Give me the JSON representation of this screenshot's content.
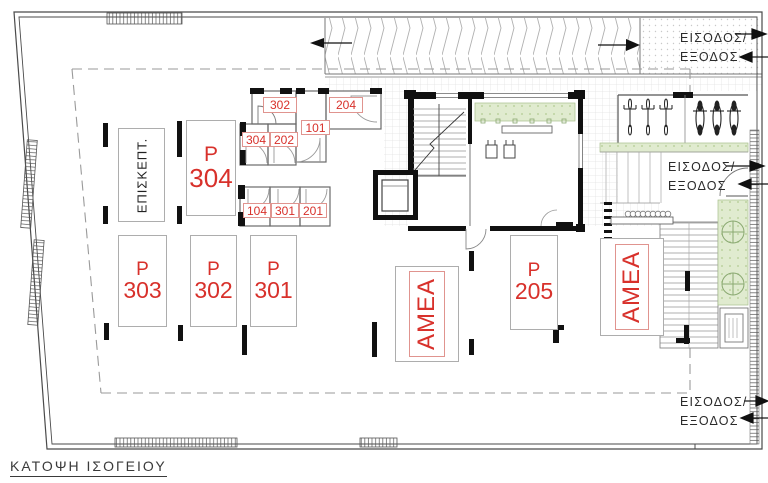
{
  "title": "ΚΑΤΟΨΗ ΙΣΟΓΕΙΟΥ",
  "colors": {
    "label_red": "#d8312b",
    "wall_black": "#111111",
    "line_gray": "#777777",
    "planting_green": "#e0ebcf"
  },
  "entrances": {
    "top_right": {
      "line1": "ΕΙΣΟΔΟΣ/",
      "line2": "ΕΞΟΔΟΣ"
    },
    "mid_right": {
      "line1": "ΕΙΣΟΔΟΣ/",
      "line2": "ΕΞΟΔΟΣ"
    },
    "bottom_right": {
      "line1": "ΕΙΣΟΔΟΣ/",
      "line2": "ΕΞΟΔΟΣ"
    }
  },
  "parking": {
    "visitor": {
      "label": "ΕΠΙΣΚΕΠΤ."
    },
    "p304": {
      "letter": "P",
      "number": "304"
    },
    "p303": {
      "letter": "P",
      "number": "303"
    },
    "p302": {
      "letter": "P",
      "number": "302"
    },
    "p301": {
      "letter": "P",
      "number": "301"
    },
    "p205": {
      "letter": "P",
      "number": "205"
    },
    "amea_left": {
      "label": "ΑΜΕΑ"
    },
    "amea_right": {
      "label": "ΑΜΕΑ"
    }
  },
  "storerooms": {
    "s302": "302",
    "s204": "204",
    "s101": "101",
    "s304": "304",
    "s202": "202",
    "s104": "104",
    "s301": "301",
    "s201": "201"
  }
}
